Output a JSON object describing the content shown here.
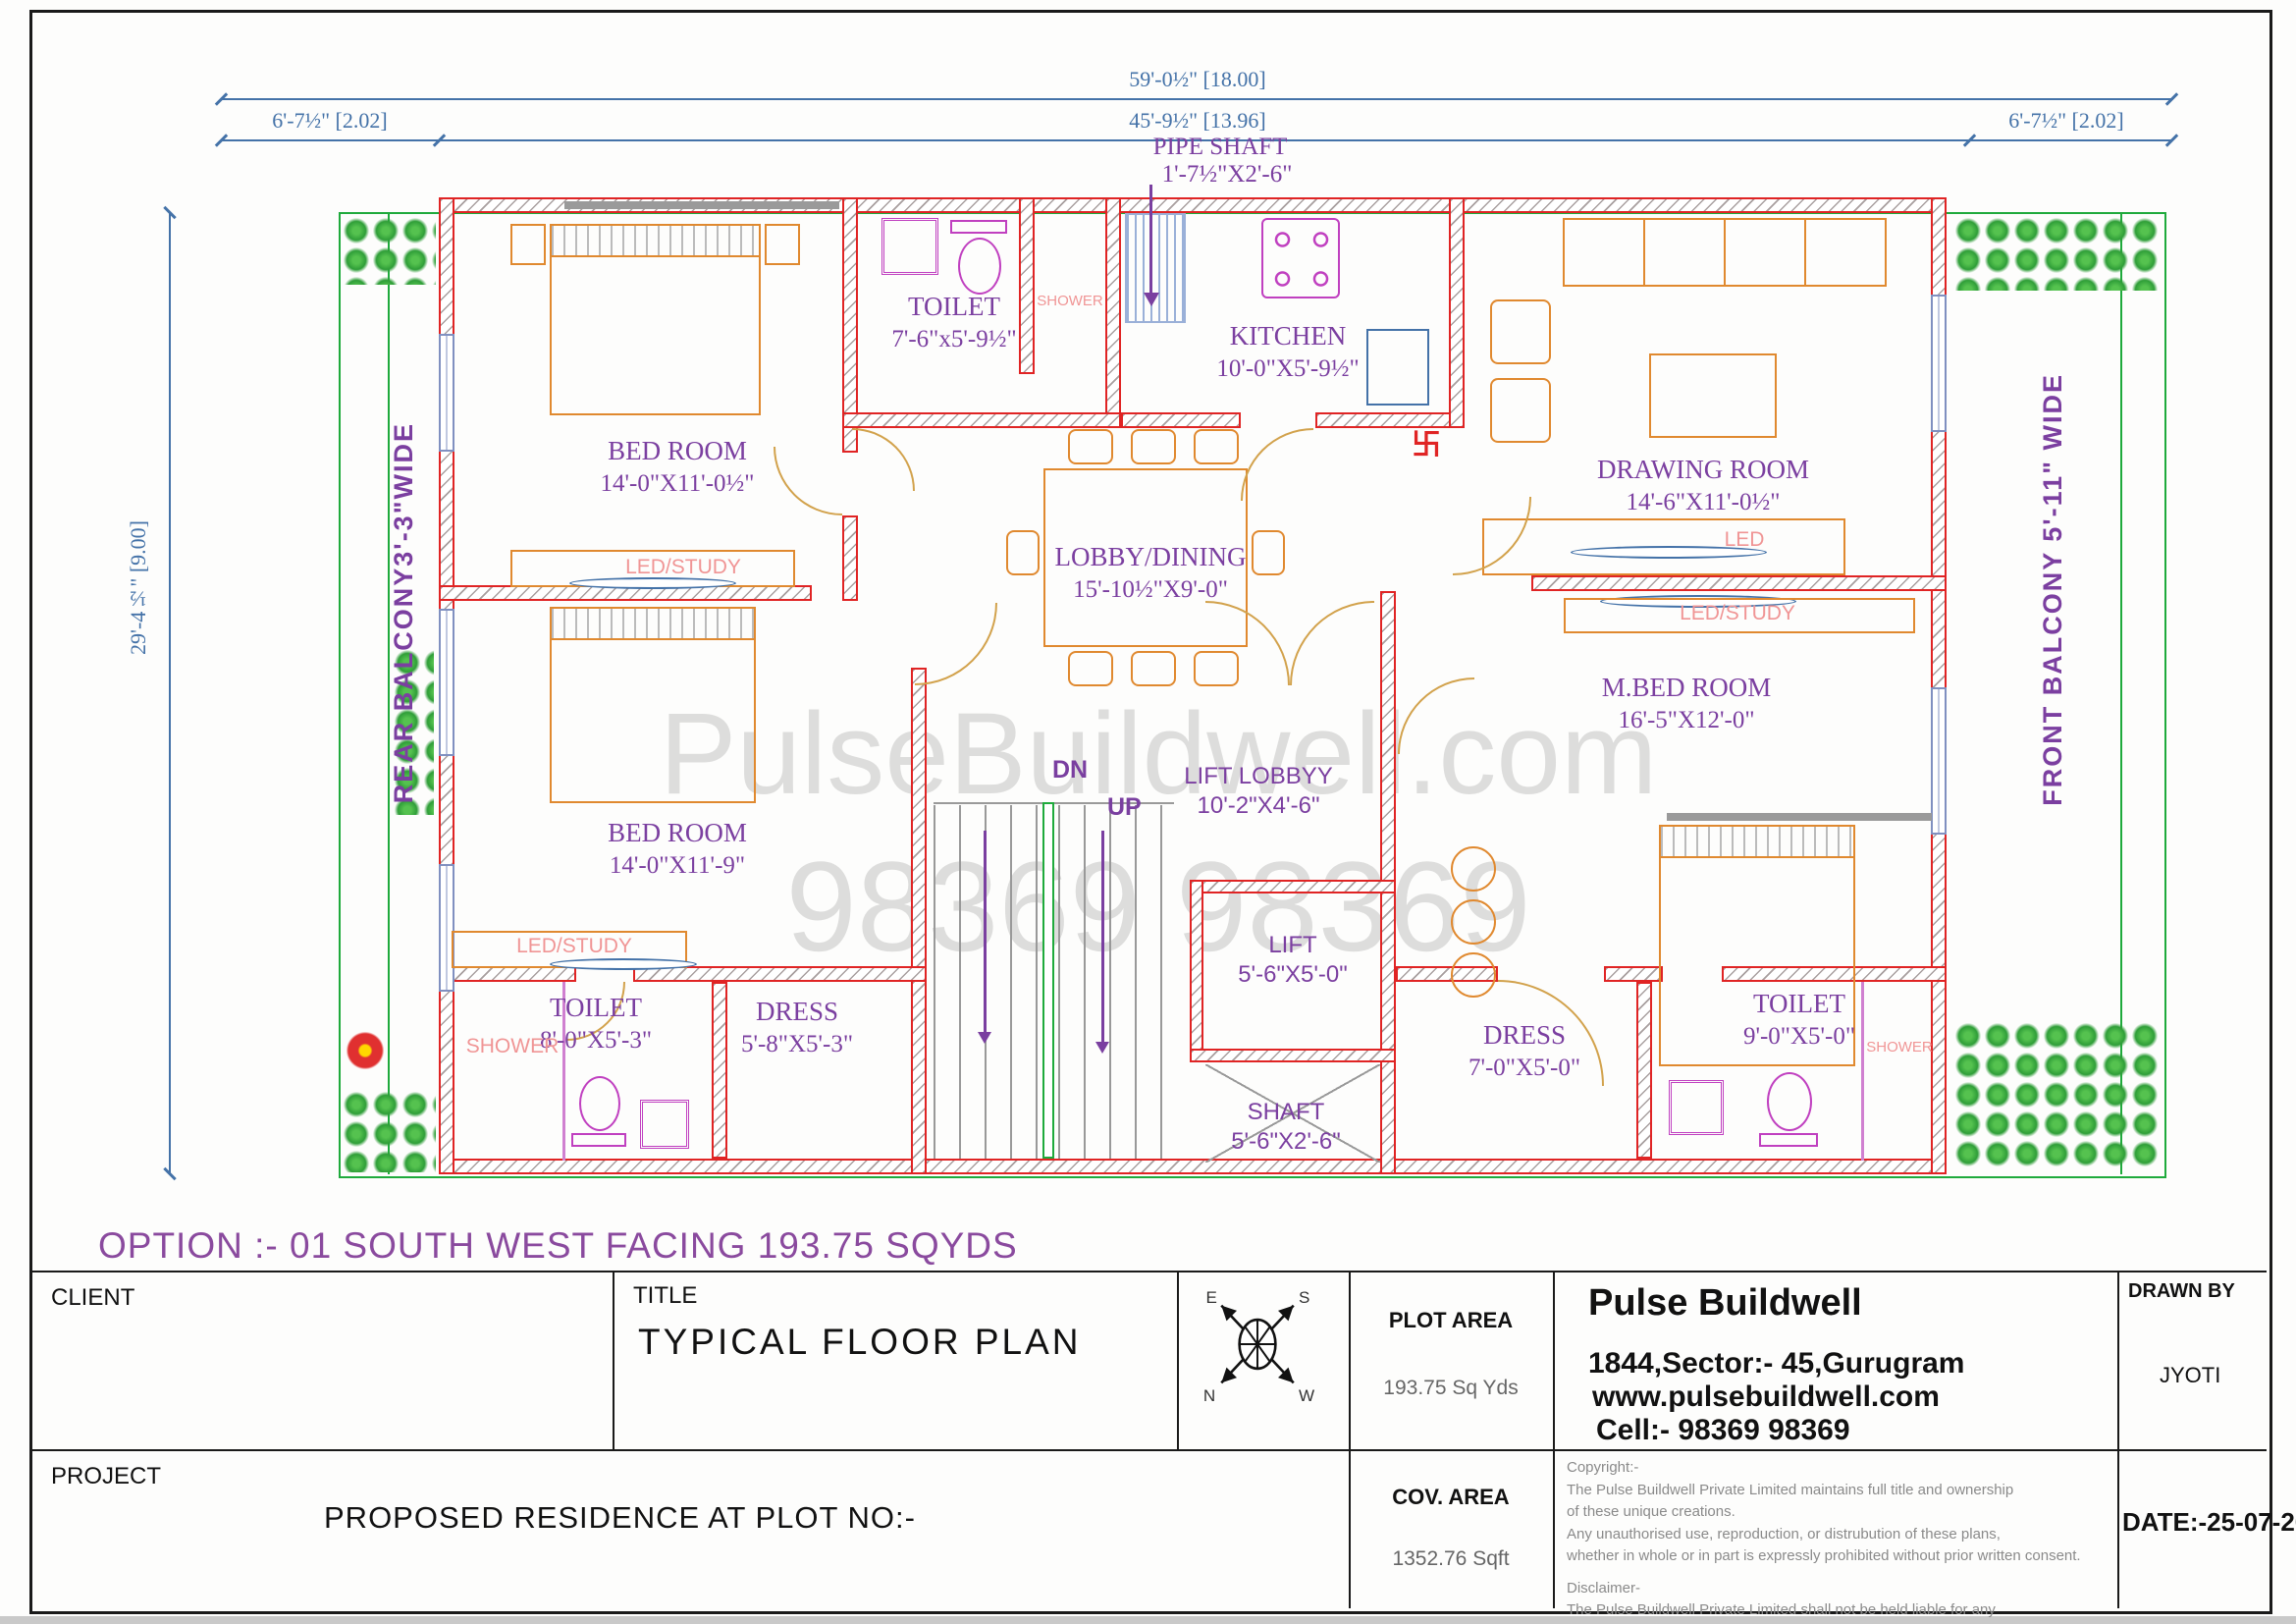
{
  "sheet": {
    "option_note": "OPTION :- 01 SOUTH  WEST FACING 193.75 SQYDS",
    "watermark_line1": "PulseBuildwell.com",
    "watermark_line2": "98369 98369"
  },
  "dimensions": {
    "overall_width": "59'-0½\" [18.00]",
    "left_offset": "6'-7½\" [2.02]",
    "inner_width": "45'-9½\" [13.96]",
    "right_offset": "6'-7½\" [2.02]",
    "overall_height": "29'-4½\" [9.00]"
  },
  "annotations": {
    "pipe_shaft_name": "PIPE SHAFT",
    "pipe_shaft_size": "1'-7½\"X2'-6\"",
    "rear_balcony": "REAR  BALCONY3'-3\"WIDE",
    "front_balcony": "FRONT BALCONY 5'-11\" WIDE",
    "dn": "DN",
    "up": "UP",
    "swastika": "卐"
  },
  "rooms": {
    "bedroom1": {
      "name": "BED ROOM",
      "size": "14'-0\"X11'-0½\""
    },
    "toilet_top": {
      "name": "TOILET",
      "size": "7'-6\"x5'-9½\""
    },
    "kitchen": {
      "name": "KITCHEN",
      "size": "10'-0\"X5'-9½\""
    },
    "drawing_room": {
      "name": "DRAWING ROOM",
      "size": "14'-6\"X11'-0½\""
    },
    "lobby_dining": {
      "name": "LOBBY/DINING",
      "size": "15'-10½\"X9'-0\""
    },
    "master_bedroom": {
      "name": "M.BED ROOM",
      "size": "16'-5\"X12'-0\""
    },
    "bedroom2": {
      "name": "BED ROOM",
      "size": "14'-0\"X11'-9\""
    },
    "lift_lobby": {
      "name": "LIFT LOBBYY",
      "size": "10'-2\"X4'-6\""
    },
    "lift": {
      "name": "LIFT",
      "size": "5'-6\"X5'-0\""
    },
    "toilet_bl": {
      "name": "TOILET",
      "size": "8'-0\"X5'-3\""
    },
    "dress_left": {
      "name": "DRESS",
      "size": "5'-8\"X5'-3\""
    },
    "dress_right": {
      "name": "DRESS",
      "size": "7'-0\"X5'-0\""
    },
    "toilet_br": {
      "name": "TOILET",
      "size": "9'-0\"X5'-0\""
    },
    "shaft": {
      "name": "SHAFT",
      "size": "5'-6\"X2'-6\""
    }
  },
  "sub_labels": {
    "shower": "SHOWER",
    "led_study": "LED/STUDY",
    "led": "LED"
  },
  "title_block": {
    "client_label": "CLIENT",
    "title_label": "TITLE",
    "title_value": "TYPICAL  FLOOR PLAN",
    "project_label": "PROJECT",
    "project_value": "PROPOSED RESIDENCE AT PLOT NO:-",
    "plot_area_label": "PLOT AREA",
    "plot_area_value": "193.75  Sq Yds",
    "cov_area_label": "COV. AREA",
    "cov_area_value": "1352.76 Sqft",
    "company_name": "Pulse Buildwell",
    "company_address": "1844,Sector:- 45,Gurugram",
    "company_website": "www.pulsebuildwell.com",
    "company_cell": "Cell:- 98369 98369",
    "drawn_by_label": "DRAWN BY",
    "drawn_by_value": "JYOTI",
    "date_value": "DATE:-25-07-2025",
    "compass": {
      "e": "E",
      "s": "S",
      "n": "N",
      "w": "W"
    },
    "copyright_lines": [
      "Copyright:-",
      "The Pulse Buildwell Private Limited maintains full title and ownership",
      "of these unique creations.",
      "Any unauthorised use, reproduction, or distrubution of these plans,",
      "whether in whole or in part is expressly prohibited without prior written consent.",
      "Disclaimer-",
      "The Pulse Buildwell Private Limited shall not be held liable for any",
      "errors,omissions,or deficiencies in any form by any party whatsoever."
    ]
  },
  "colors": {
    "wall_red": "#e02424",
    "dimension_blue": "#4472a8",
    "label_purple": "#7b3fa0",
    "accent_pink": "#f09595",
    "boundary_green": "#1faa3c",
    "furniture_orange": "#e0892f",
    "fixture_magenta": "#c040c0"
  }
}
